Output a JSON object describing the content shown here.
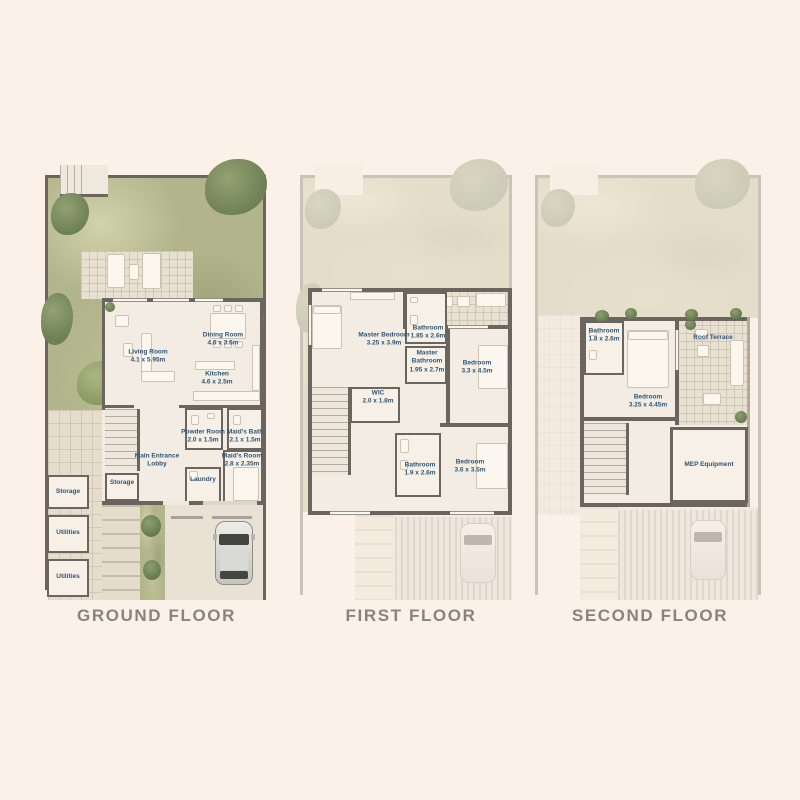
{
  "colors": {
    "background": "#fcf1e8",
    "wall": "#6b655f",
    "room_label": "#2e5578",
    "garden_green": "#b2b58c",
    "floor_title": "#8a827b"
  },
  "floors": {
    "ground": {
      "title": "GROUND FLOOR",
      "rooms": {
        "living": {
          "name": "Living Room",
          "dims": "4.1 x 5.95m"
        },
        "dining": {
          "name": "Dining Room",
          "dims": "4.6 x 3.6m"
        },
        "kitchen": {
          "name": "Kitchen",
          "dims": "4.6 x 2.5m"
        },
        "powder": {
          "name": "Powder Room",
          "dims": "2.0 x 1.5m"
        },
        "maids_bath": {
          "name": "Maid's Bath",
          "dims": "2.1 x 1.5m"
        },
        "lobby": {
          "name": "Main Entrance Lobby",
          "dims": ""
        },
        "maids_room": {
          "name": "Maid's Room",
          "dims": "2.8 x 2.35m"
        },
        "laundry": {
          "name": "Laundry",
          "dims": ""
        },
        "storage_inner": {
          "name": "Storage",
          "dims": ""
        },
        "storage_left": {
          "name": "Storage",
          "dims": ""
        },
        "utilities_upper": {
          "name": "Utilities",
          "dims": ""
        },
        "utilities_lower": {
          "name": "Utilities",
          "dims": ""
        }
      }
    },
    "first": {
      "title": "FIRST FLOOR",
      "rooms": {
        "master_bedroom": {
          "name": "Master Bedroom",
          "dims": "3.25 x 3.9m"
        },
        "bathroom_top": {
          "name": "Bathroom",
          "dims": "1.85 x 2.6m"
        },
        "master_bathroom": {
          "name": "Master Bathroom",
          "dims": "1.95 x 2.7m"
        },
        "bedroom_right": {
          "name": "Bedroom",
          "dims": "3.3 x 4.5m"
        },
        "wic": {
          "name": "WIC",
          "dims": "2.0 x 1.8m"
        },
        "bathroom_bottom": {
          "name": "Bathroom",
          "dims": "1.9 x 2.6m"
        },
        "bedroom_bottom": {
          "name": "Bedroom",
          "dims": "3.6 x 3.5m"
        }
      }
    },
    "second": {
      "title": "SECOND FLOOR",
      "rooms": {
        "bathroom": {
          "name": "Bathroom",
          "dims": "1.8 x 2.6m"
        },
        "roof_terrace": {
          "name": "Roof Terrace",
          "dims": ""
        },
        "bedroom": {
          "name": "Bedroom",
          "dims": "3.25 x 4.45m"
        },
        "mep": {
          "name": "MEP Equipment",
          "dims": ""
        }
      }
    }
  }
}
